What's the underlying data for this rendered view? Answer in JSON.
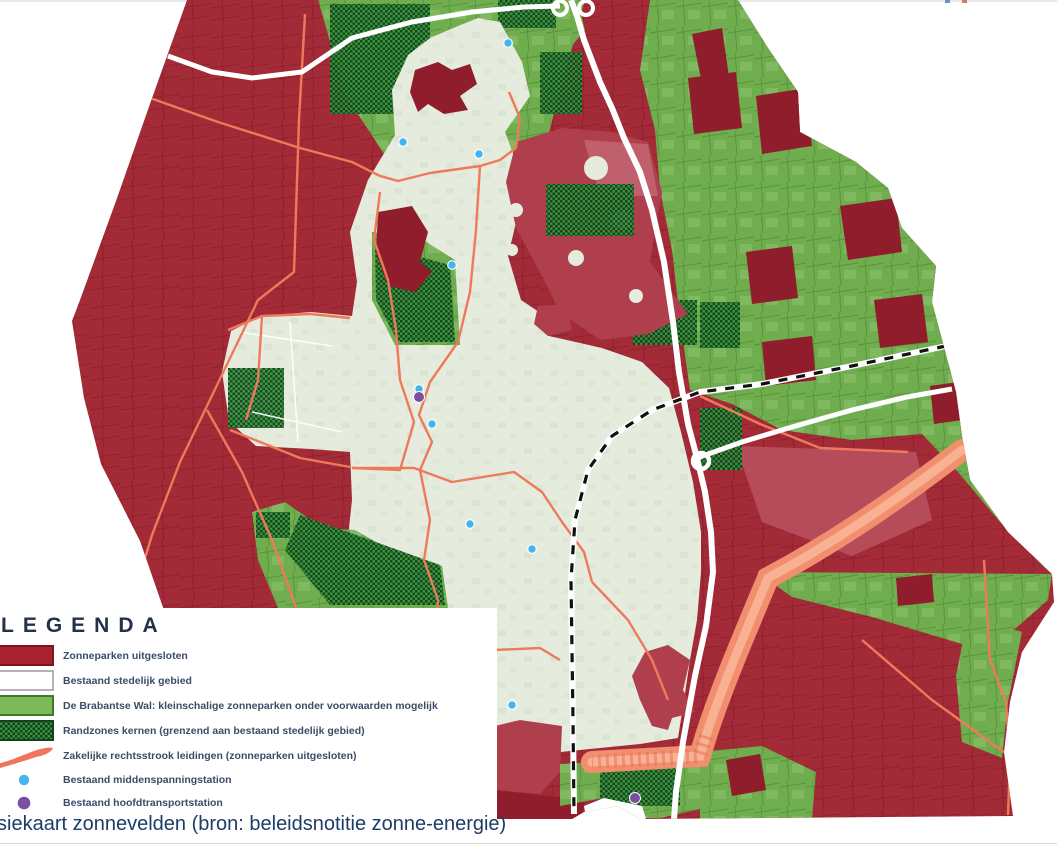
{
  "page": {
    "caption": "siekaart zonnevelden (bron: beleidsnotitie zonne-energie)"
  },
  "legend": {
    "title": "LEGENDA",
    "items": [
      {
        "swatch": "rect",
        "color": "#A8212E",
        "label": "Zonneparken uitgesloten"
      },
      {
        "swatch": "rect",
        "color": "#FFFFFF",
        "label": "Bestaand stedelijk gebied"
      },
      {
        "swatch": "rect",
        "color": "#7CBA58",
        "label": "De Brabantse Wal: kleinschalige zonneparken onder voorwaarden mogelijk"
      },
      {
        "swatch": "hatch",
        "color": "#2E7D33",
        "label": "Randzones kernen (grenzend aan bestaand stedelijk gebied)"
      },
      {
        "swatch": "stroke",
        "color": "#F0755B",
        "label": "Zakelijke rechtsstrook leidingen (zonneparken uitgesloten)"
      },
      {
        "swatch": "dot",
        "color": "#45B5EE",
        "label": "Bestaand middenspanningstation"
      },
      {
        "swatch": "dot",
        "color": "#7B4FA2",
        "label": "Bestaand hoofdtransportstation"
      }
    ]
  },
  "map": {
    "colors": {
      "red_base": "#A32B37",
      "red_line": "#7D1322",
      "red_dark": "#8F1D2B",
      "crimson": "#AF3F4D",
      "crimson_light": "#C26672",
      "light_red": "#B8505E",
      "green_base": "#6FAD4E",
      "green_light": "#93C672",
      "green_line": "#49842F",
      "hatch_light": "#38913E",
      "hatch_dark": "#10431A",
      "mint": "#E5ECDE",
      "mint_shade": "#D3DFCB",
      "salmon": "#EE7A5B",
      "corridor": "#F18E6E",
      "corridor_light": "#F8B597",
      "road": "#FFFFFF",
      "rail": "#111111",
      "station_blue": "#41B6EE",
      "station_purple": "#7B4FA2"
    },
    "stations_medium_voltage": [
      [
        508,
        43
      ],
      [
        403,
        142
      ],
      [
        479,
        154
      ],
      [
        452,
        265
      ],
      [
        419,
        389
      ],
      [
        432,
        424
      ],
      [
        470,
        524
      ],
      [
        532,
        549
      ],
      [
        512,
        705
      ]
    ],
    "stations_main_transport": [
      [
        419,
        397
      ],
      [
        635,
        798
      ]
    ]
  }
}
